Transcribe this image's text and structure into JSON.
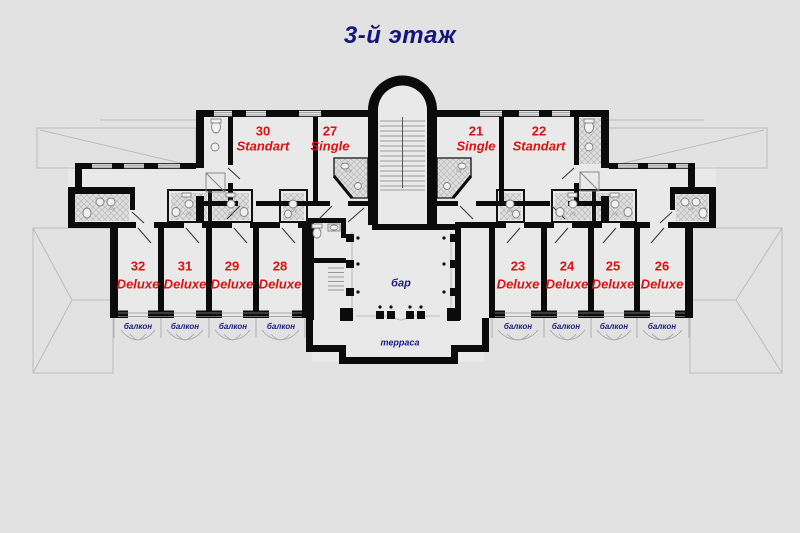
{
  "title": "3-й этаж",
  "rooms": {
    "upper": [
      {
        "num": "30",
        "type": "Standart"
      },
      {
        "num": "27",
        "type": "Single"
      },
      {
        "num": "21",
        "type": "Single"
      },
      {
        "num": "22",
        "type": "Standart"
      }
    ],
    "lower": [
      {
        "num": "32",
        "type": "Deluxe"
      },
      {
        "num": "31",
        "type": "Deluxe"
      },
      {
        "num": "29",
        "type": "Deluxe"
      },
      {
        "num": "28",
        "type": "Deluxe"
      },
      {
        "num": "23",
        "type": "Deluxe"
      },
      {
        "num": "24",
        "type": "Deluxe"
      },
      {
        "num": "25",
        "type": "Deluxe"
      },
      {
        "num": "26",
        "type": "Deluxe"
      }
    ]
  },
  "labels": {
    "bar": "бар",
    "terrace": "терраса",
    "balcony": "балкон",
    "wc": "с/у"
  },
  "colors": {
    "room_label": "#dd1111",
    "navy_label": "#1b1b80",
    "wall": "#0b0b0b",
    "background": "#e2e2e2"
  }
}
